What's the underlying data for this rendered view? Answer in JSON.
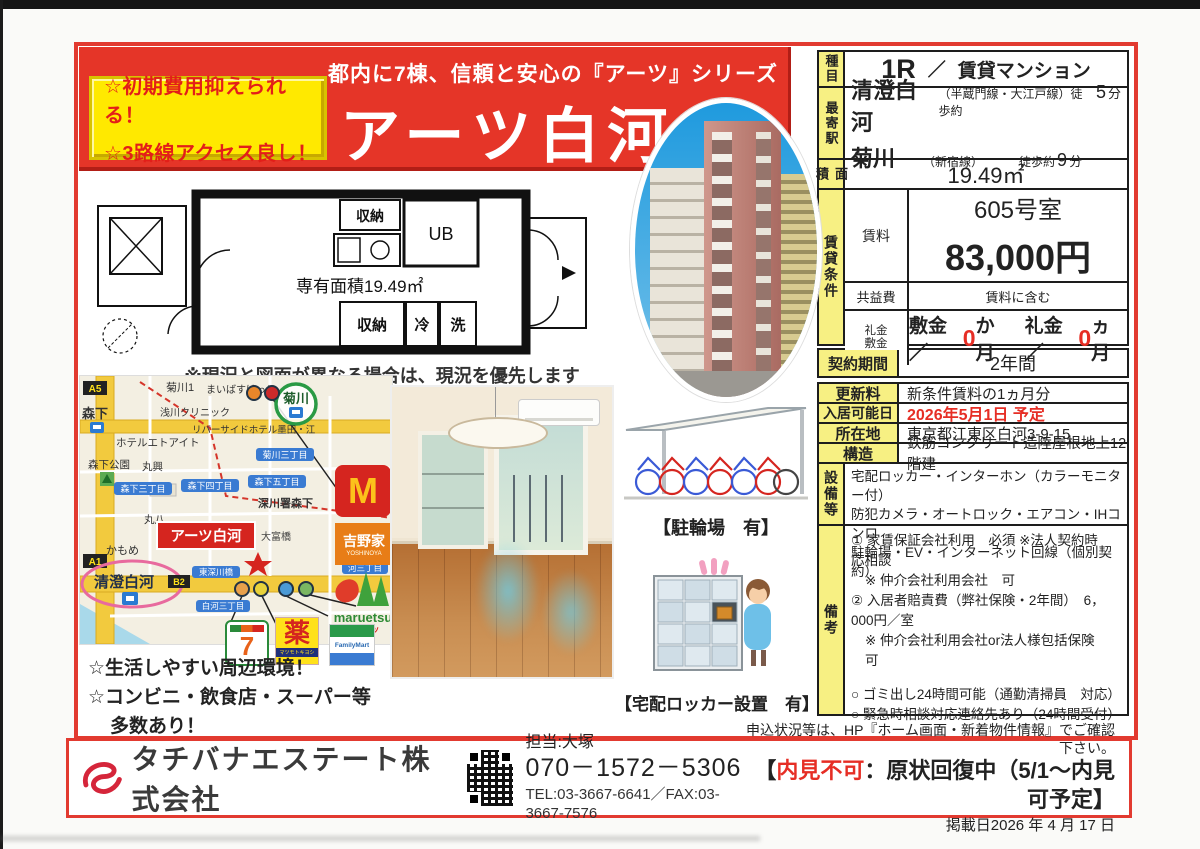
{
  "badge": {
    "line1": "☆初期費用抑えられる！",
    "line2": "☆3路線アクセス良し！"
  },
  "banner": {
    "subtitle": "都内に7棟、信頼と安心の『アーツ』シリーズ",
    "title": "アーツ白河"
  },
  "colors": {
    "accent_red": "#e53528",
    "label_yellow": "#f7f083",
    "badge_yellow": "#ffe900",
    "text_red": "#e62e25"
  },
  "floorplan": {
    "area": "専有面積19.49㎡",
    "closet_top": "収納",
    "ub": "UB",
    "closet_bottom": "収納",
    "fridge": "冷",
    "wash": "洗",
    "note": "※現況と図面が異なる場合は、現況を優先します"
  },
  "map": {
    "a5": "A5",
    "kikukawa1": "菊川1",
    "maibasu": "まいばすけっと",
    "kikukawa_st": "菊川",
    "morishita_st": "森下",
    "asakawa": "浅川クリニック",
    "hotel": "ホテルエトアイト",
    "riverside": "リバーサイドホテル墨田・江",
    "kikukawa3": "菊川三丁目",
    "park": "森下公園",
    "maruko": "丸興",
    "morishita3": "森下三丁目",
    "morishita4": "森下四丁目",
    "morishita5": "森下五丁目",
    "fukagawa": "深川署森下",
    "maruhachi": "丸八",
    "property": "アーツ白河",
    "otomibashi": "大富橋",
    "kamome": "かもめ",
    "a1": "A1",
    "kiyosumi": "清澄白河",
    "b2": "B2",
    "higashifukagawa": "東深川橋",
    "shirakawa3": "白河三丁目",
    "kawa3": "河三丁目"
  },
  "brands": {
    "mcdonalds": "M",
    "yoshinoya": "吉野家",
    "yoshinoya_en": "YOSHINOYA",
    "maruetsu": "maruetsu",
    "maruetsu_kana": "マルエツ",
    "seven": "7",
    "yakkyoku": "薬",
    "matsumoto": "マツモトキヨシ",
    "familymart": "FamilyMart"
  },
  "map_notes": {
    "line1": "☆生活しやすい周辺環境！",
    "line2": "☆コンビニ・飲食店・スーパー等",
    "line3": "多数あり！"
  },
  "captions": {
    "bike": "【駐輪場　有】",
    "locker": "【宅配ロッカー設置　有】"
  },
  "table": {
    "type_label": "種目",
    "type_main": "1R",
    "type_sep": "／",
    "type_sub": "賃貸マンション",
    "station_label": "最寄駅",
    "st1_name": "清澄白河",
    "st1_pre": "（半蔵門線・大江戸線）徒歩約",
    "st1_min": "5",
    "st1_unit": "分",
    "st2_name": "菊川",
    "st2_pre": "（新宿線）",
    "st2_mid": "徒歩約",
    "st2_min": "9",
    "st2_unit": "分",
    "area_label": "面積",
    "area_value": "19.49㎡",
    "cond_label": "賃貸条件",
    "rent_label": "賃料",
    "room": "605号室",
    "rent": "83,000円",
    "fee_label": "共益費",
    "fee_value": "賃料に含む",
    "dep_label1": "礼金",
    "dep_label2": "敷金",
    "dep_p1": "敷金／",
    "dep_v1": "0",
    "dep_p2": "か月",
    "dep_p3": "礼金／",
    "dep_v2": "0",
    "dep_p4": "ヵ月",
    "term_label": "契約期間",
    "term_value": "2年間",
    "renew_label": "更新料",
    "renew_value": "新条件賃料の1ヵ月分",
    "movein_label": "入居可能日",
    "movein_value": "2026年5月1日 予定",
    "addr_label": "所在地",
    "addr_value": "東京都江東区白河3-9-15",
    "struct_label": "構造",
    "struct_value": "鉄筋コンクリート造陸屋根地上12階建",
    "equip_label": "設備等",
    "equip1": "宅配ロッカー・インターホン（カラーモニター付）",
    "equip2": "防犯カメラ・オートロック・エアコン・IHコンロ",
    "equip3": "駐輪場・EV・インターネット回線（個別契約）",
    "remarks_label": "備考",
    "rm1": "① 家賃保証会社利用　必須 ※法人契約時　応相談",
    "rm2": "※ 仲介会社利用会社　可",
    "rm3": "② 入居者賠責費（弊社保険・2年間）　6，000円／室",
    "rm4": "※ 仲介会社利用会社or法人様包括保険　可",
    "rm5": "○ ゴミ出し24時間可能（通勤清掃員　対応）",
    "rm6": "○ 緊急時相談対応連絡先あり（24時間受付）",
    "rm7": "● 契約時ご負担下さい。",
    "rm8": "★退去時のルームクリーニング代（税別50,000円）",
    "rm9": "★鍵交換費用（税別15,000円）"
  },
  "footer": {
    "company": "タチバナエステート株式会社",
    "contact": "担当:大塚",
    "mobile": "070－1572－5306",
    "telfax": "TEL:03-3667-6641／FAX:03-3667-7576",
    "info": "申込状況等は、HP『ホーム画面・新着物件情報』でご確認下さい。",
    "notice_pre": "【",
    "notice_red": "内見不可",
    "notice_post": "：原状回復中（5/1～内見可予定】",
    "date": "掲載日2026 年 4 月 17 日"
  }
}
